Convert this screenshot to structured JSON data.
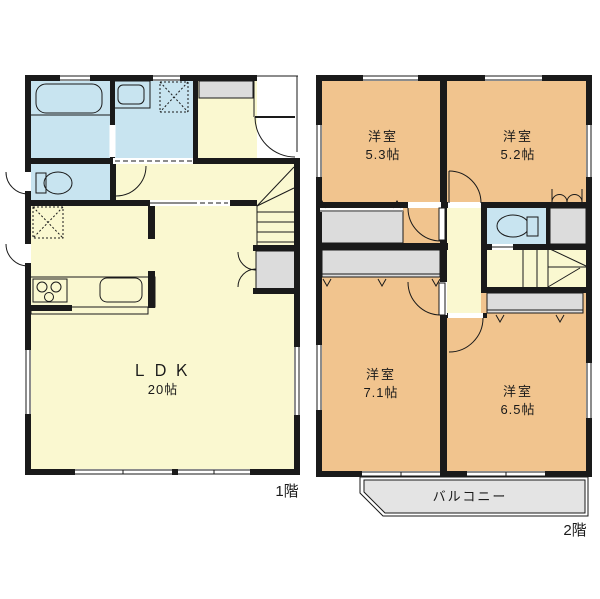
{
  "title": "2-story house floor plan",
  "floor1": {
    "floor_label": "1階",
    "ldk_name": "ＬＤＫ",
    "ldk_size": "20帖"
  },
  "floor2": {
    "floor_label": "2階",
    "room_53_name": "洋室",
    "room_53_size": "5.3帖",
    "room_52_name": "洋室",
    "room_52_size": "5.2帖",
    "room_71_name": "洋室",
    "room_71_size": "7.1帖",
    "room_65_name": "洋室",
    "room_65_size": "6.5帖",
    "balcony_label": "バルコニー"
  },
  "colors": {
    "room_cream": "#FAF8D0",
    "wet_area_blue": "#C8E4F0",
    "bedroom_tan": "#F1C48E",
    "closet_gray": "#DCDCDC",
    "balcony_gray": "#E4E4E4",
    "wall_black": "#1a1a1a",
    "background": "#FFFFFF"
  }
}
